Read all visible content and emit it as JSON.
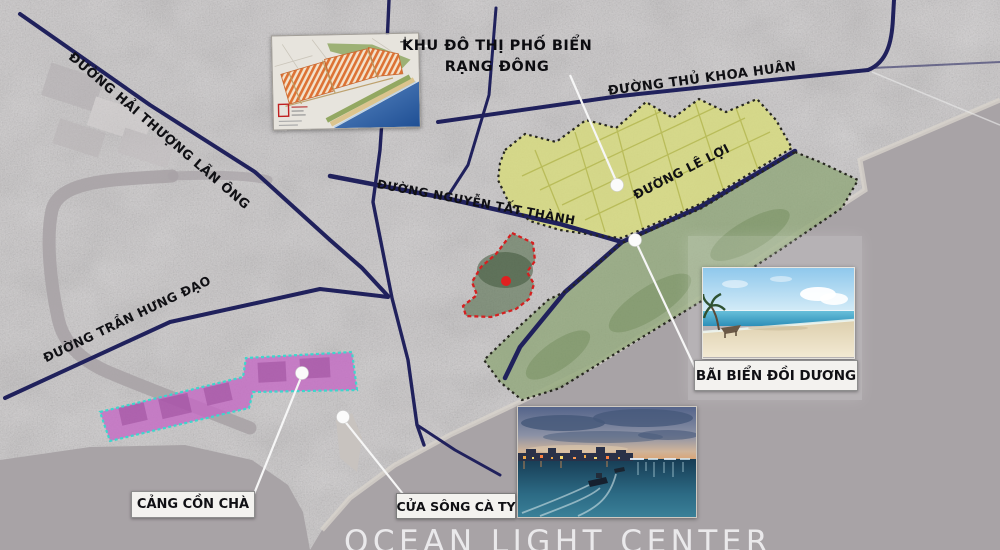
{
  "project_label": {
    "line1": "KHU ĐÔ THỊ PHỐ BIỂN",
    "line2": "RẠNG ĐÔNG"
  },
  "roads": {
    "hai_thuong_lan_ong": "ĐƯỜNG HẢI THƯỢNG LÃN ÔNG",
    "thu_khoa_huan": "ĐƯỜNG THỦ KHOA HUÂN",
    "nguyen_tat_thanh": "ĐƯỜNG NGUYỄN TẤT THÀNH",
    "le_loi": "ĐƯỜNG LÊ LỢI",
    "tran_hung_dao": "ĐƯỜNG TRẦN HƯNG ĐẠO"
  },
  "callouts": {
    "beach": "BÃI BIỂN ĐỒI DƯƠNG",
    "port": "CẢNG CỒN CHÀ",
    "river_mouth": "CỬA SÔNG CÀ TY"
  },
  "watermark": "OCEAN LIGHT CENTER",
  "legend_colors": {
    "planned_urban_zone_yellow": "#d8dc7d",
    "coastal_beach_zone_green": "#8ba371",
    "port_zone_magenta": "#c468c4",
    "port_zone_border_cyan": "#3fd6cc",
    "project_site_border_red": "#d42020",
    "main_road_navy": "#20215c",
    "water_gray": "#a8a3a6"
  }
}
